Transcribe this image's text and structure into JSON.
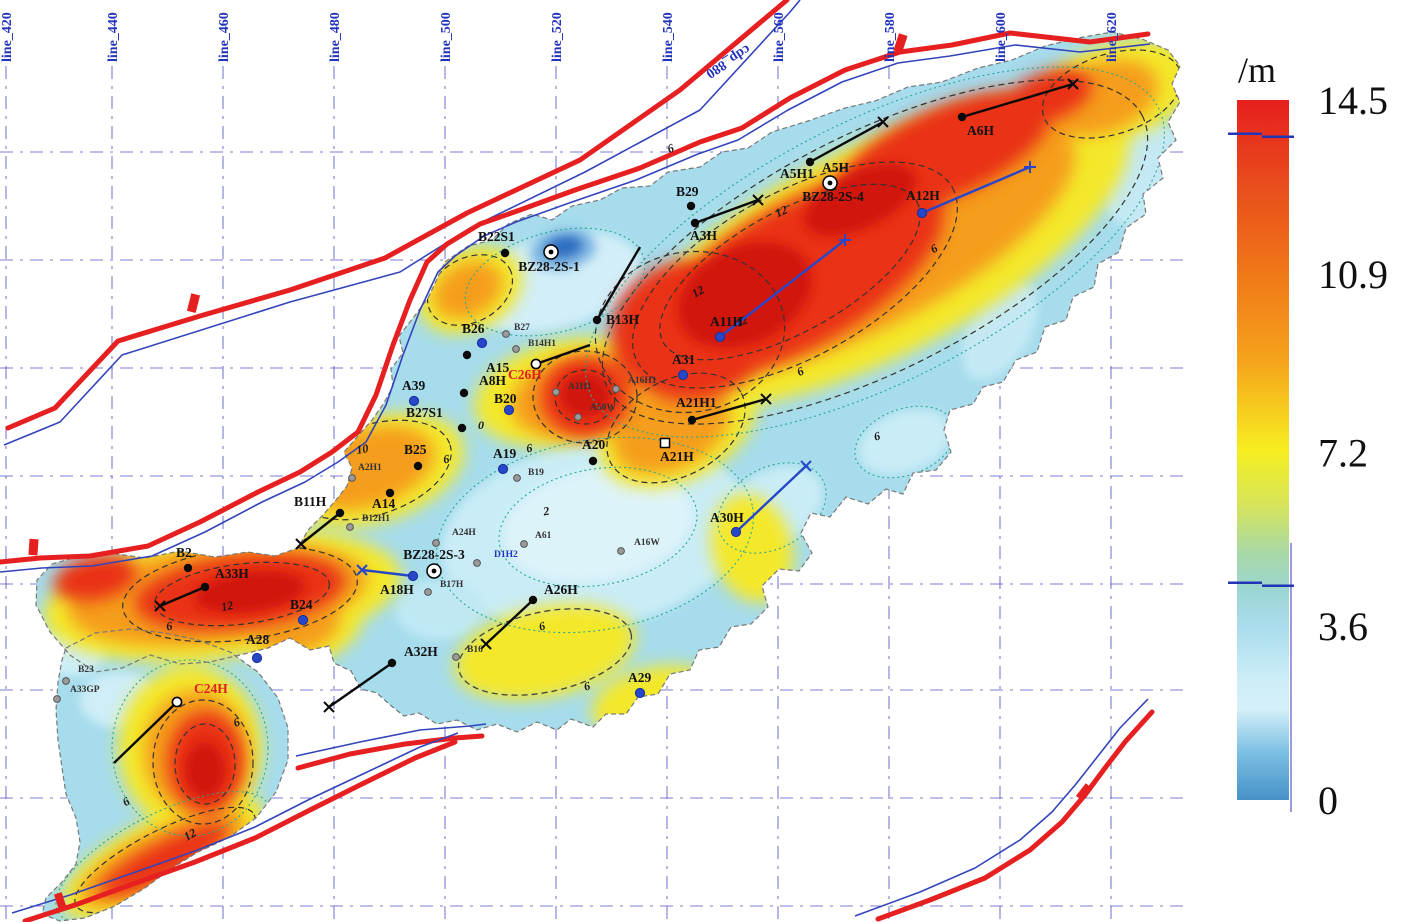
{
  "grid": {
    "color": "#5b5bc4",
    "vertical_lines": [
      {
        "label": "line_420",
        "x": 6
      },
      {
        "label": "line_440",
        "x": 112
      },
      {
        "label": "line_460",
        "x": 223
      },
      {
        "label": "line_480",
        "x": 334
      },
      {
        "label": "line_500",
        "x": 445
      },
      {
        "label": "line_520",
        "x": 556
      },
      {
        "label": "line_540",
        "x": 667
      },
      {
        "label": "line_560",
        "x": 778
      },
      {
        "label": "line_580",
        "x": 889
      },
      {
        "label": "line_600",
        "x": 1000
      },
      {
        "label": "line_620",
        "x": 1111
      }
    ],
    "horizontal_y": [
      152,
      260,
      368,
      476,
      584,
      690,
      798,
      906
    ],
    "cdp_label": {
      "text": "cdp_880",
      "x": 726,
      "y": 58,
      "rot": 147
    }
  },
  "colorbar": {
    "unit_label": "/m",
    "x": 1237,
    "width": 52,
    "top": 100,
    "bottom": 800,
    "label_x": 1318,
    "ticks": [
      {
        "value": 14.5,
        "label": "14.5"
      },
      {
        "value": 10.9,
        "label": "10.9"
      },
      {
        "value": 7.2,
        "label": "7.2"
      },
      {
        "value": 3.6,
        "label": "3.6"
      },
      {
        "value": 0,
        "label": "0"
      }
    ],
    "marker_line_values": [
      13.8,
      4.5
    ],
    "gradient": [
      {
        "o": 0,
        "c": "#e71f1e"
      },
      {
        "o": 12,
        "c": "#e94c1c"
      },
      {
        "o": 25,
        "c": "#f07818"
      },
      {
        "o": 37,
        "c": "#f5a21b"
      },
      {
        "o": 50,
        "c": "#f6ee20"
      },
      {
        "o": 58,
        "c": "#d5e45c"
      },
      {
        "o": 65,
        "c": "#a7d8a8"
      },
      {
        "o": 70,
        "c": "#9cd6d2"
      },
      {
        "o": 75,
        "c": "#a8dcec"
      },
      {
        "o": 83,
        "c": "#cdeef8"
      },
      {
        "o": 87,
        "c": "#d4f0f8"
      },
      {
        "o": 93,
        "c": "#7fc0e4"
      },
      {
        "o": 100,
        "c": "#4692c8"
      }
    ]
  },
  "wells": [
    {
      "name": "B29",
      "x": 691,
      "y": 206,
      "sym": "black",
      "lx": 676,
      "ly": 196,
      "lc": "#111"
    },
    {
      "name": "A3H",
      "x": 695,
      "y": 223,
      "sym": "black",
      "lx": 690,
      "ly": 240,
      "lc": "#111",
      "traj": [
        758,
        200,
        "x"
      ]
    },
    {
      "name": "A5H1",
      "x": 810,
      "y": 162,
      "sym": "black",
      "lx": 780,
      "ly": 178,
      "lc": "#111",
      "traj": [
        883,
        122,
        "x"
      ]
    },
    {
      "name": "A5H",
      "x": 822,
      "y": 158,
      "sym": "none",
      "lx": 822,
      "ly": 172,
      "lc": "#111"
    },
    {
      "name": "BZ28-2S-4",
      "x": 830,
      "y": 183,
      "sym": "bullseye",
      "lx": 833,
      "ly": 201,
      "lc": "#111",
      "anchor": "middle"
    },
    {
      "name": "A6H",
      "x": 962,
      "y": 117,
      "sym": "black",
      "lx": 967,
      "ly": 135,
      "lc": "#111",
      "traj": [
        1073,
        84,
        "x"
      ]
    },
    {
      "name": "A12H",
      "x": 922,
      "y": 213,
      "sym": "blue",
      "lx": 906,
      "ly": 200,
      "lc": "#111",
      "traj": [
        1030,
        167,
        "+"
      ]
    },
    {
      "name": "A11H",
      "x": 720,
      "y": 337,
      "sym": "blue",
      "lx": 710,
      "ly": 326,
      "lc": "#111",
      "traj": [
        845,
        240,
        "+"
      ]
    },
    {
      "name": "B13H",
      "x": 597,
      "y": 320,
      "sym": "black",
      "lx": 606,
      "ly": 324,
      "lc": "#111",
      "traj": [
        640,
        247,
        "none"
      ]
    },
    {
      "name": "B22S1",
      "x": 505,
      "y": 253,
      "sym": "black",
      "lx": 478,
      "ly": 241,
      "lc": "#111"
    },
    {
      "name": "BZ28-2S-1",
      "x": 551,
      "y": 252,
      "sym": "bullseye",
      "lx": 549,
      "ly": 271,
      "lc": "#111",
      "anchor": "middle"
    },
    {
      "name": "B26",
      "x": 482,
      "y": 343,
      "sym": "blue",
      "lx": 462,
      "ly": 333,
      "lc": "#111"
    },
    {
      "name": "A31",
      "x": 683,
      "y": 375,
      "sym": "blue",
      "lx": 672,
      "ly": 364,
      "lc": "#111"
    },
    {
      "name": "A21H1",
      "x": 692,
      "y": 420,
      "sym": "black",
      "lx": 676,
      "ly": 407,
      "lc": "#111",
      "traj": [
        766,
        399,
        "x"
      ]
    },
    {
      "name": "A21H",
      "x": 665,
      "y": 443,
      "sym": "opensquare",
      "lx": 660,
      "ly": 461,
      "lc": "#111"
    },
    {
      "name": "A20",
      "x": 593,
      "y": 461,
      "sym": "black",
      "lx": 582,
      "ly": 449,
      "lc": "#111"
    },
    {
      "name": "A19",
      "x": 503,
      "y": 469,
      "sym": "blue",
      "lx": 493,
      "ly": 458,
      "lc": "#111"
    },
    {
      "name": "B25",
      "x": 418,
      "y": 466,
      "sym": "black",
      "lx": 404,
      "ly": 454,
      "lc": "#111"
    },
    {
      "name": "B27S1",
      "x": 462,
      "y": 428,
      "sym": "black",
      "lx": 406,
      "ly": 417,
      "lc": "#111"
    },
    {
      "name": "A14",
      "x": 390,
      "y": 493,
      "sym": "black",
      "lx": 372,
      "ly": 508,
      "lc": "#111"
    },
    {
      "name": "A39",
      "x": 414,
      "y": 401,
      "sym": "blue",
      "lx": 402,
      "ly": 390,
      "lc": "#111"
    },
    {
      "name": "C26H",
      "x": 536,
      "y": 364,
      "sym": "white",
      "lx": 508,
      "ly": 379,
      "lc": "#e02020",
      "traj": [
        590,
        345,
        "none"
      ]
    },
    {
      "name": "A15",
      "x": 467,
      "y": 355,
      "sym": "black",
      "lx": 486,
      "ly": 372,
      "lc": "#111"
    },
    {
      "name": "A8H",
      "x": 464,
      "y": 393,
      "sym": "black",
      "lx": 479,
      "ly": 385,
      "lc": "#111"
    },
    {
      "name": "B20",
      "x": 509,
      "y": 410,
      "sym": "blue",
      "lx": 494,
      "ly": 403,
      "lc": "#111"
    },
    {
      "name": "A30H",
      "x": 736,
      "y": 532,
      "sym": "blue",
      "lx": 710,
      "ly": 522,
      "lc": "#111",
      "traj": [
        806,
        466,
        "x"
      ]
    },
    {
      "name": "B11H",
      "x": 340,
      "y": 513,
      "sym": "black",
      "lx": 294,
      "ly": 506,
      "lc": "#111",
      "traj": [
        301,
        544,
        "x"
      ]
    },
    {
      "name": "B2",
      "x": 188,
      "y": 568,
      "sym": "black",
      "lx": 176,
      "ly": 557,
      "lc": "#111"
    },
    {
      "name": "A33H",
      "x": 205,
      "y": 587,
      "sym": "black",
      "lx": 215,
      "ly": 578,
      "lc": "#111",
      "traj": [
        160,
        606,
        "x"
      ]
    },
    {
      "name": "B24",
      "x": 303,
      "y": 620,
      "sym": "blue",
      "lx": 290,
      "ly": 609,
      "lc": "#111"
    },
    {
      "name": "A28",
      "x": 257,
      "y": 658,
      "sym": "blue",
      "lx": 246,
      "ly": 644,
      "lc": "#111"
    },
    {
      "name": "A32H",
      "x": 392,
      "y": 663,
      "sym": "black",
      "lx": 404,
      "ly": 656,
      "lc": "#111",
      "traj": [
        329,
        707,
        "x"
      ]
    },
    {
      "name": "A26H",
      "x": 533,
      "y": 600,
      "sym": "black",
      "lx": 544,
      "ly": 594,
      "lc": "#111",
      "traj": [
        486,
        644,
        "x"
      ]
    },
    {
      "name": "A18H",
      "x": 413,
      "y": 576,
      "sym": "blue",
      "lx": 380,
      "ly": 594,
      "lc": "#111",
      "traj": [
        362,
        570,
        "x"
      ]
    },
    {
      "name": "BZ28-2S-3",
      "x": 434,
      "y": 571,
      "sym": "bullseye",
      "lx": 434,
      "ly": 559,
      "lc": "#111",
      "anchor": "middle"
    },
    {
      "name": "A29",
      "x": 640,
      "y": 693,
      "sym": "blue",
      "lx": 628,
      "ly": 682,
      "lc": "#111"
    },
    {
      "name": "C24H",
      "x": 177,
      "y": 702,
      "sym": "white",
      "lx": 194,
      "ly": 693,
      "lc": "#e02020",
      "traj": [
        114,
        763,
        "none"
      ]
    },
    {
      "name": "B27",
      "x": 506,
      "y": 334,
      "sym": "gray",
      "lx": 514,
      "ly": 330,
      "lc": "#333",
      "small": true
    },
    {
      "name": "B14H1",
      "x": 516,
      "y": 349,
      "sym": "gray",
      "lx": 528,
      "ly": 346,
      "lc": "#333",
      "small": true
    },
    {
      "name": "A1H1",
      "x": 556,
      "y": 392,
      "sym": "gray",
      "lx": 568,
      "ly": 389,
      "lc": "#333",
      "small": true
    },
    {
      "name": "A16H1",
      "x": 616,
      "y": 389,
      "sym": "gray",
      "lx": 628,
      "ly": 383,
      "lc": "#333",
      "small": true
    },
    {
      "name": "A50W",
      "x": 578,
      "y": 417,
      "sym": "gray",
      "lx": 590,
      "ly": 410,
      "lc": "#333",
      "small": true
    },
    {
      "name": "B19",
      "x": 517,
      "y": 478,
      "sym": "gray",
      "lx": 528,
      "ly": 475,
      "lc": "#333",
      "small": true
    },
    {
      "name": "A24H",
      "x": 436,
      "y": 543,
      "sym": "gray",
      "lx": 452,
      "ly": 535,
      "lc": "#333",
      "small": true
    },
    {
      "name": "D1H2",
      "x": 477,
      "y": 563,
      "sym": "gray",
      "lx": 494,
      "ly": 557,
      "lc": "#2233bb",
      "small": true
    },
    {
      "name": "A61",
      "x": 524,
      "y": 544,
      "sym": "gray",
      "lx": 535,
      "ly": 538,
      "lc": "#333",
      "small": true
    },
    {
      "name": "A16W",
      "x": 621,
      "y": 551,
      "sym": "gray",
      "lx": 634,
      "ly": 545,
      "lc": "#333",
      "small": true
    },
    {
      "name": "B16",
      "x": 456,
      "y": 657,
      "sym": "gray",
      "lx": 467,
      "ly": 652,
      "lc": "#333",
      "small": true
    },
    {
      "name": "B17H",
      "x": 428,
      "y": 592,
      "sym": "gray",
      "lx": 440,
      "ly": 587,
      "lc": "#333",
      "small": true
    },
    {
      "name": "B12H1",
      "x": 350,
      "y": 527,
      "sym": "gray",
      "lx": 362,
      "ly": 521,
      "lc": "#333",
      "small": true
    },
    {
      "name": "A2H1",
      "x": 352,
      "y": 478,
      "sym": "gray",
      "lx": 358,
      "ly": 470,
      "lc": "#333",
      "small": true
    },
    {
      "name": "B23",
      "x": 66,
      "y": 681,
      "sym": "gray",
      "lx": 78,
      "ly": 672,
      "lc": "#333",
      "small": true
    },
    {
      "name": "A33GP",
      "x": 57,
      "y": 699,
      "sym": "gray",
      "lx": 70,
      "ly": 692,
      "lc": "#333",
      "small": true
    }
  ],
  "contour_labels": [
    {
      "t": "6",
      "x": 672,
      "y": 152,
      "r": -20
    },
    {
      "t": "12",
      "x": 783,
      "y": 215,
      "r": -25
    },
    {
      "t": "12",
      "x": 700,
      "y": 295,
      "r": -30
    },
    {
      "t": "12",
      "x": 743,
      "y": 325,
      "r": -20
    },
    {
      "t": "6",
      "x": 936,
      "y": 252,
      "r": -30
    },
    {
      "t": "6",
      "x": 802,
      "y": 375,
      "r": -25
    },
    {
      "t": "6",
      "x": 878,
      "y": 440,
      "r": -15
    },
    {
      "t": "0",
      "x": 481,
      "y": 429,
      "r": 0
    },
    {
      "t": "6",
      "x": 447,
      "y": 463,
      "r": -10
    },
    {
      "t": "6",
      "x": 530,
      "y": 452,
      "r": -10
    },
    {
      "t": "2",
      "x": 547,
      "y": 515,
      "r": -10
    },
    {
      "t": "10",
      "x": 363,
      "y": 453,
      "r": -10
    },
    {
      "t": "6",
      "x": 543,
      "y": 630,
      "r": -15
    },
    {
      "t": "6",
      "x": 588,
      "y": 690,
      "r": -15
    },
    {
      "t": "12",
      "x": 228,
      "y": 610,
      "r": -12
    },
    {
      "t": "6",
      "x": 170,
      "y": 630,
      "r": -12
    },
    {
      "t": "6",
      "x": 238,
      "y": 726,
      "r": -20
    },
    {
      "t": "12",
      "x": 192,
      "y": 838,
      "r": -30
    },
    {
      "t": "6",
      "x": 128,
      "y": 805,
      "r": -30
    }
  ],
  "chart_data": {
    "type": "heatmap",
    "title": "",
    "value_unit": "/m",
    "value_range": [
      0,
      14.5
    ],
    "colorbar_ticks": [
      14.5,
      10.9,
      7.2,
      3.6,
      0
    ],
    "survey_lines": [
      "line_420",
      "line_440",
      "line_460",
      "line_480",
      "line_500",
      "line_520",
      "line_540",
      "line_560",
      "line_580",
      "line_600",
      "line_620"
    ],
    "cdp_line": "cdp_880",
    "legend_position": "right"
  }
}
